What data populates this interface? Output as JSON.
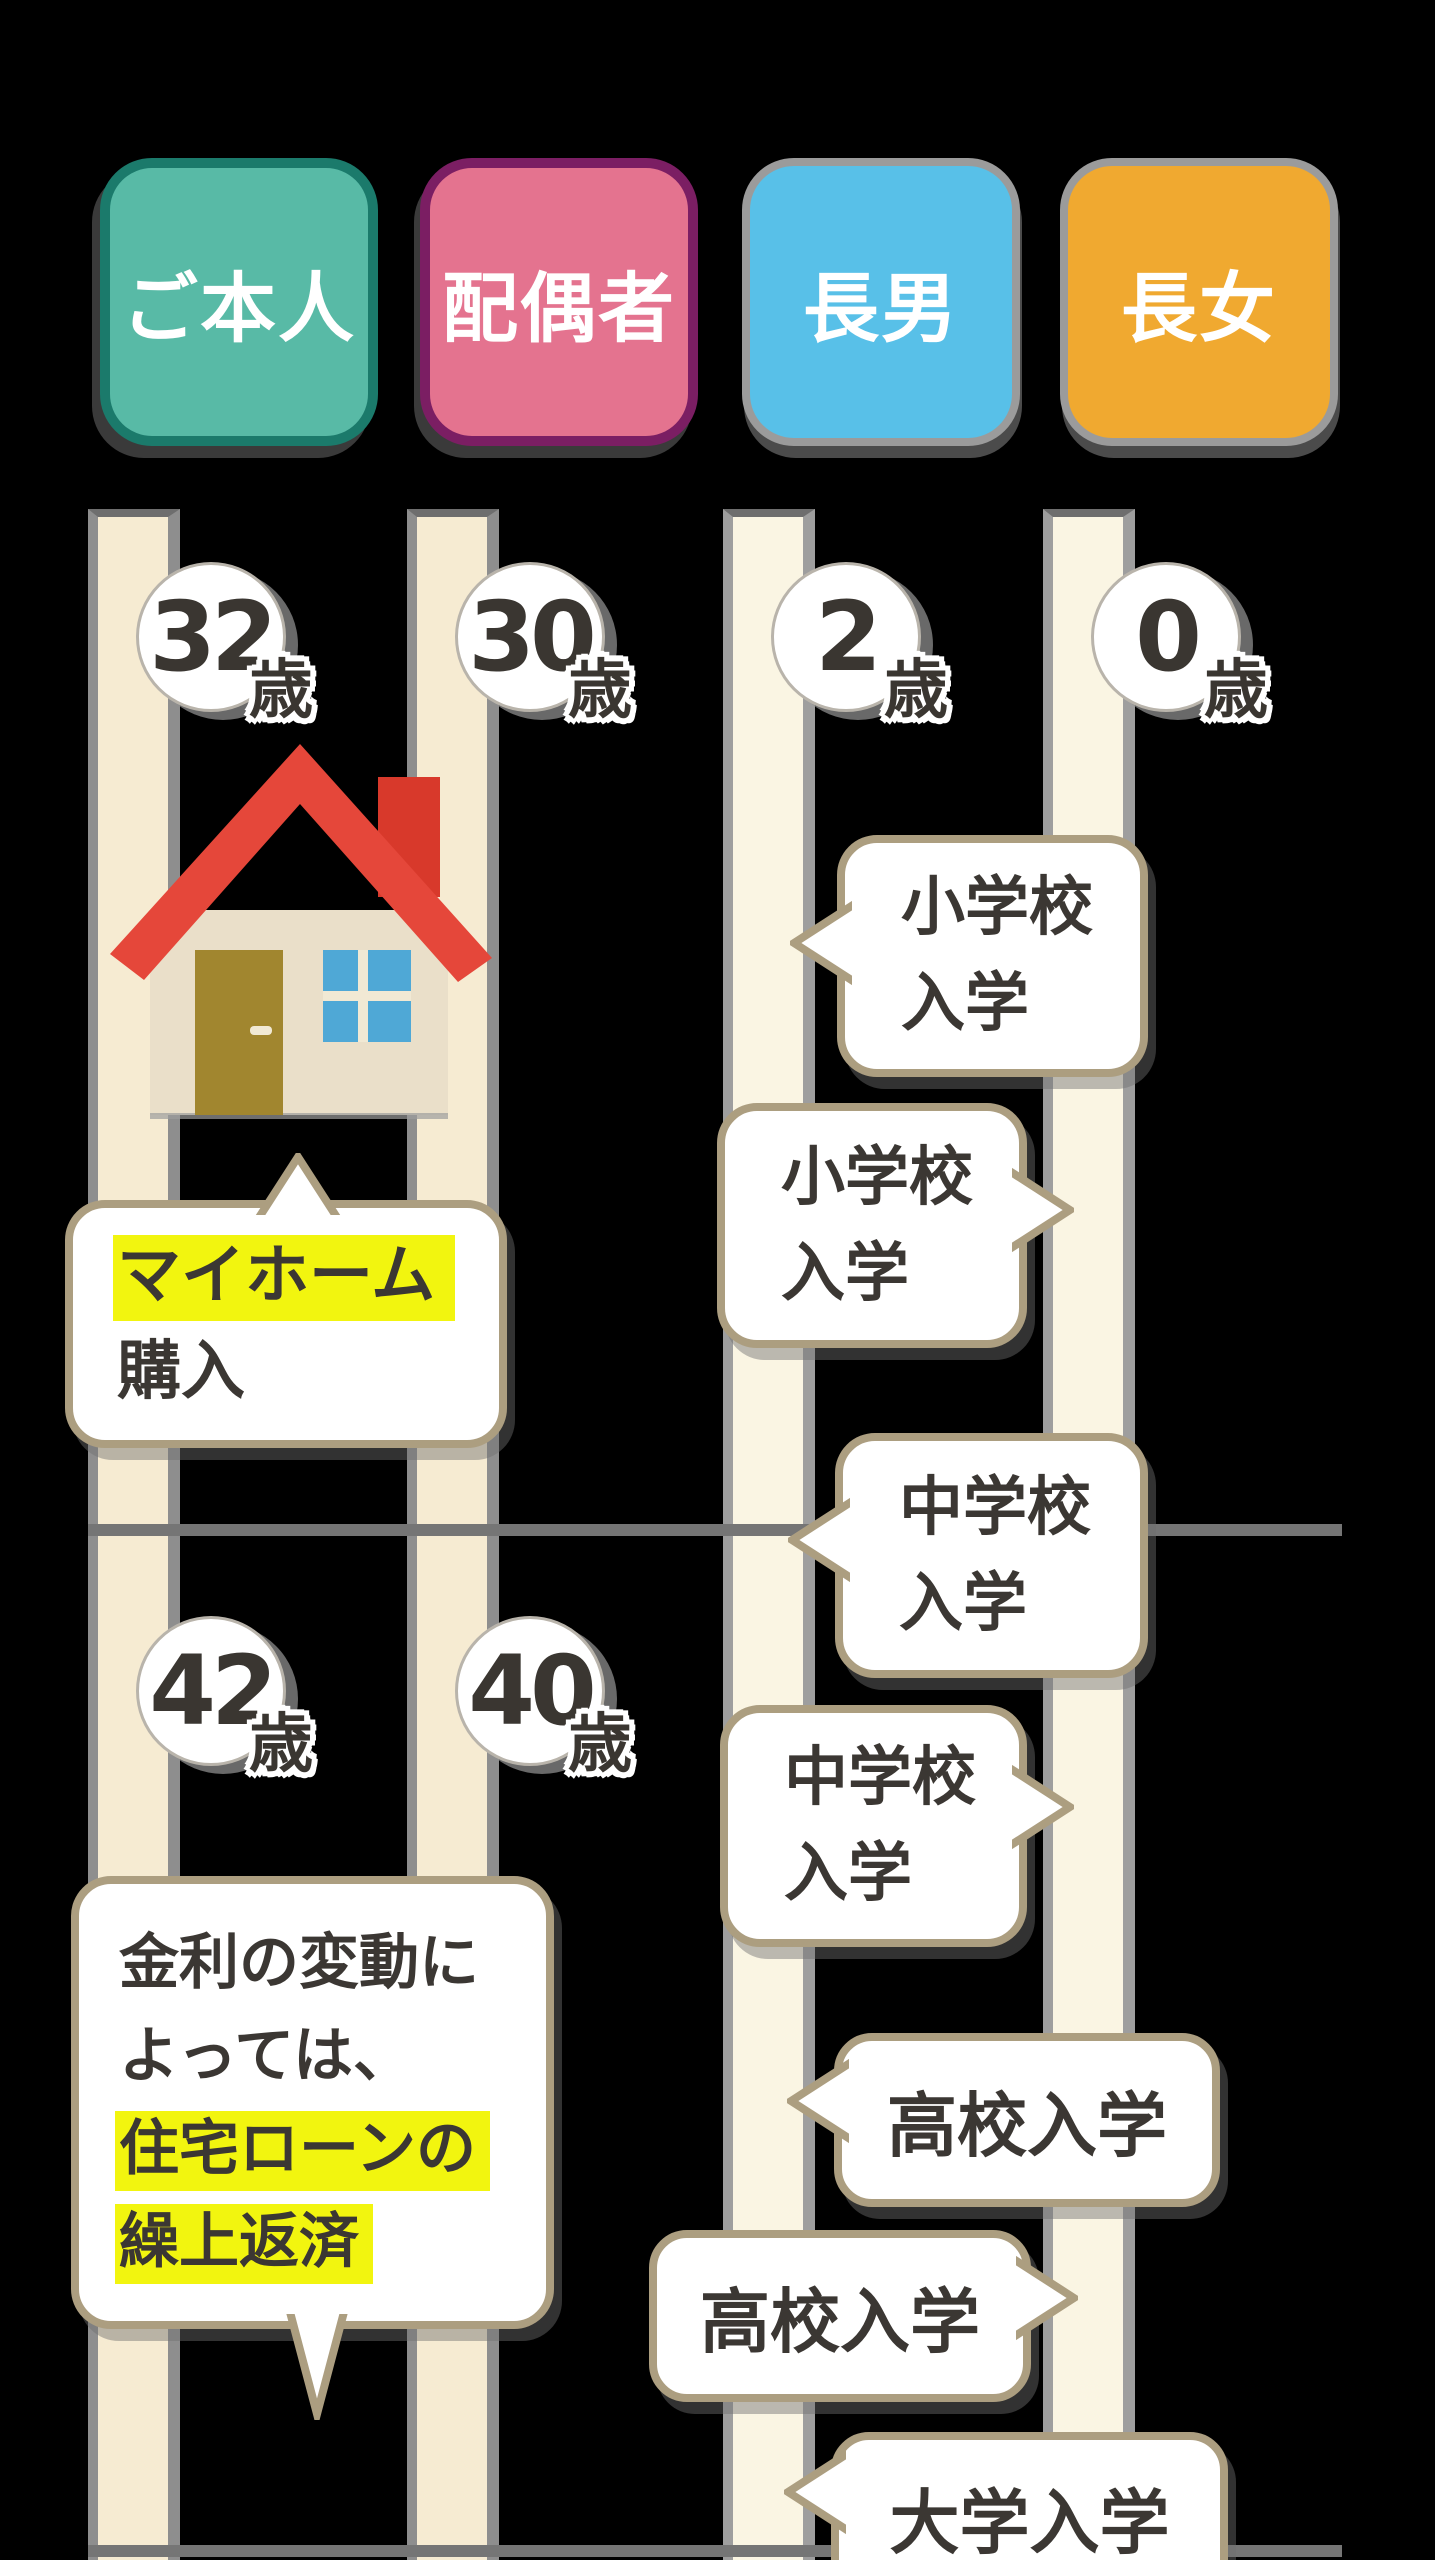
{
  "canvas": {
    "width": 1435,
    "height": 2560,
    "background": "#000000"
  },
  "colors": {
    "background": "#000000",
    "highlight_yellow": "#F2F50F",
    "bubble_border": "#AC9E80",
    "bubble_fill": "#FFFFFF",
    "text_dark": "#3B3733",
    "bar_adult": "#F6EBD2",
    "bar_child": "#FAF5E3",
    "bar_edge": "#8E8E8E",
    "divider_gray": "#757575",
    "house_roof": "#E5473A",
    "house_chimney": "#D8392B",
    "house_wall": "#EADFC9",
    "house_door": "#A1862F",
    "house_window": "#4FA8D6"
  },
  "legend": {
    "items": [
      {
        "label": "ご本人",
        "fill": "#58BAA6",
        "border": "#1B7A6B"
      },
      {
        "label": "配偶者",
        "fill": "#E4738F",
        "border": "#7B1E63"
      },
      {
        "label": "長男",
        "fill": "#58C0E8",
        "border": "#9B9B9B"
      },
      {
        "label": "長女",
        "fill": "#F0A930",
        "border": "#9B9B9B"
      }
    ]
  },
  "age_markers": [
    {
      "value": "32",
      "unit": "歳",
      "person": "ご本人",
      "row": 1
    },
    {
      "value": "30",
      "unit": "歳",
      "person": "配偶者",
      "row": 1
    },
    {
      "value": "2",
      "unit": "歳",
      "person": "長男",
      "row": 1
    },
    {
      "value": "0",
      "unit": "歳",
      "person": "長女",
      "row": 1
    },
    {
      "value": "42",
      "unit": "歳",
      "person": "ご本人",
      "row": 2
    },
    {
      "value": "40",
      "unit": "歳",
      "person": "配偶者",
      "row": 2
    }
  ],
  "events": [
    {
      "id": "myhome-purchase",
      "target": "ご本人",
      "pointer": "top",
      "lines": [
        {
          "text": "マイホーム",
          "highlight": true
        },
        {
          "text": "購入",
          "highlight": false
        }
      ]
    },
    {
      "id": "elementary-son",
      "target": "長男",
      "pointer": "left",
      "lines": [
        {
          "text": "小学校"
        },
        {
          "text": "入学"
        }
      ]
    },
    {
      "id": "elementary-daughter",
      "target": "長女",
      "pointer": "right",
      "lines": [
        {
          "text": "小学校"
        },
        {
          "text": "入学"
        }
      ]
    },
    {
      "id": "juniorhigh-son",
      "target": "長男",
      "pointer": "left",
      "lines": [
        {
          "text": "中学校"
        },
        {
          "text": "入学"
        }
      ]
    },
    {
      "id": "juniorhigh-daughter",
      "target": "長女",
      "pointer": "right",
      "lines": [
        {
          "text": "中学校"
        },
        {
          "text": "入学"
        }
      ]
    },
    {
      "id": "loan-note",
      "target": "ご本人",
      "pointer": "bottom",
      "lines": [
        {
          "text": "金利の変動に"
        },
        {
          "text": "よっては、"
        },
        {
          "text": "住宅ローンの",
          "highlight": true
        },
        {
          "text": "繰上返済",
          "highlight": true
        }
      ]
    },
    {
      "id": "highschool-son",
      "target": "長男",
      "pointer": "left",
      "lines": [
        {
          "text": "高校入学"
        }
      ]
    },
    {
      "id": "highschool-daughter",
      "target": "長女",
      "pointer": "right",
      "lines": [
        {
          "text": "高校入学"
        }
      ]
    },
    {
      "id": "university-son",
      "target": "長男",
      "pointer": "left",
      "lines": [
        {
          "text": "大学入学"
        }
      ]
    }
  ]
}
